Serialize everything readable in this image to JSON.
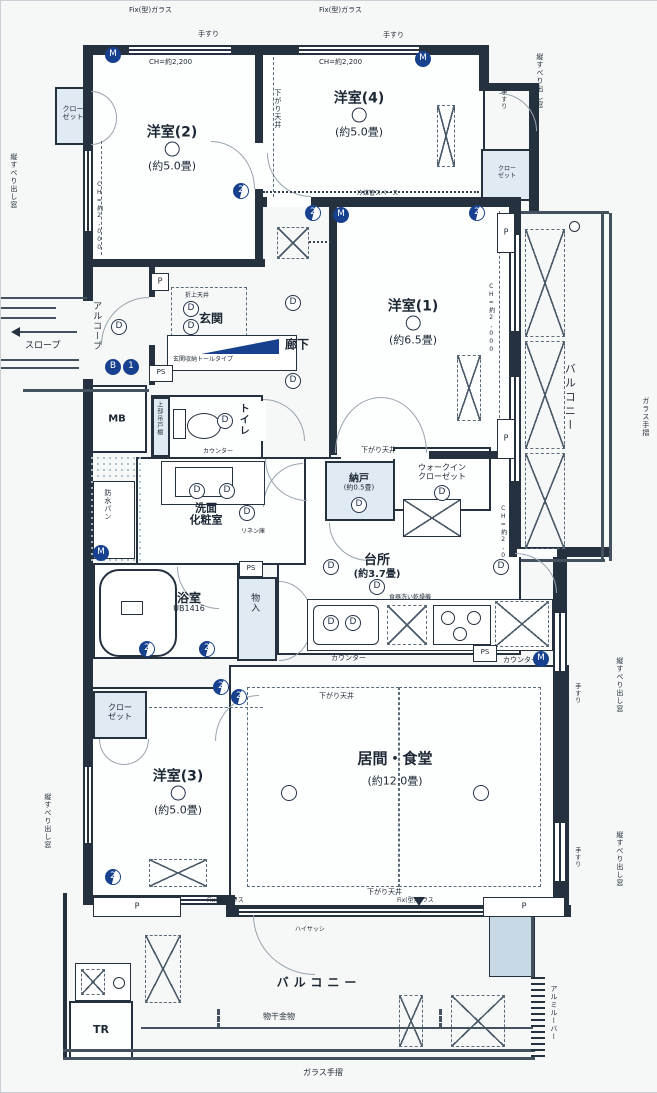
{
  "rooms": {
    "y2": {
      "name": "洋室(2)",
      "size": "(約5.0畳)"
    },
    "y4": {
      "name": "洋室(4)",
      "size": "(約5.0畳)"
    },
    "y1": {
      "name": "洋室(1)",
      "size": "(約6.5畳)"
    },
    "y3": {
      "name": "洋室(3)",
      "size": "(約5.0畳)"
    },
    "ld": {
      "name": "居間・食堂",
      "size": "(約12.0畳)"
    },
    "kitchen": {
      "name": "台所",
      "size": "(約3.7畳)"
    },
    "nando": {
      "name": "納戸",
      "size": "(約0.5畳)"
    },
    "wic": {
      "line1": "ウォークイン",
      "line2": "クローゼット"
    },
    "bath": {
      "name": "浴室",
      "size": "UB1416"
    },
    "wash": {
      "line1": "洗面",
      "line2": "化粧室"
    },
    "toilet": "トイレ",
    "genkan": "玄関",
    "rouka": "廊下",
    "balcony": "バルコニー",
    "alcove": "アルコーブ",
    "slope": "スロープ",
    "mb": "MB",
    "tr": "TR",
    "monoire": "物入",
    "closet": {
      "line1": "クロー",
      "line2": "ゼット"
    }
  },
  "ann": {
    "fix": "Fix(型)ガラス",
    "ch2200": "CH=約2,200",
    "ch2000": "CH=約2,000",
    "tesuri": "手すり",
    "sagari": "下がり天井",
    "oriage": "折上天井",
    "tate": "縦すべり出し窓",
    "glass": "ガラス手摺",
    "monohoshi": "物干金物",
    "hisash": "ハイサッシ",
    "reibai": "冷媒管スペース",
    "counter": "カウンター",
    "ps": "PS",
    "p": "P",
    "bousui": "防水パン",
    "linen": "リネン庫",
    "jobu": "上部吊戸棚",
    "getabako": "玄関収納トールタイプ",
    "louver": "アルミルーバー",
    "dishwasher": "食器洗い乾燥機"
  },
  "sym": {
    "m": "M",
    "d": "D",
    "n2": "2",
    "b": "B",
    "one": "1"
  }
}
